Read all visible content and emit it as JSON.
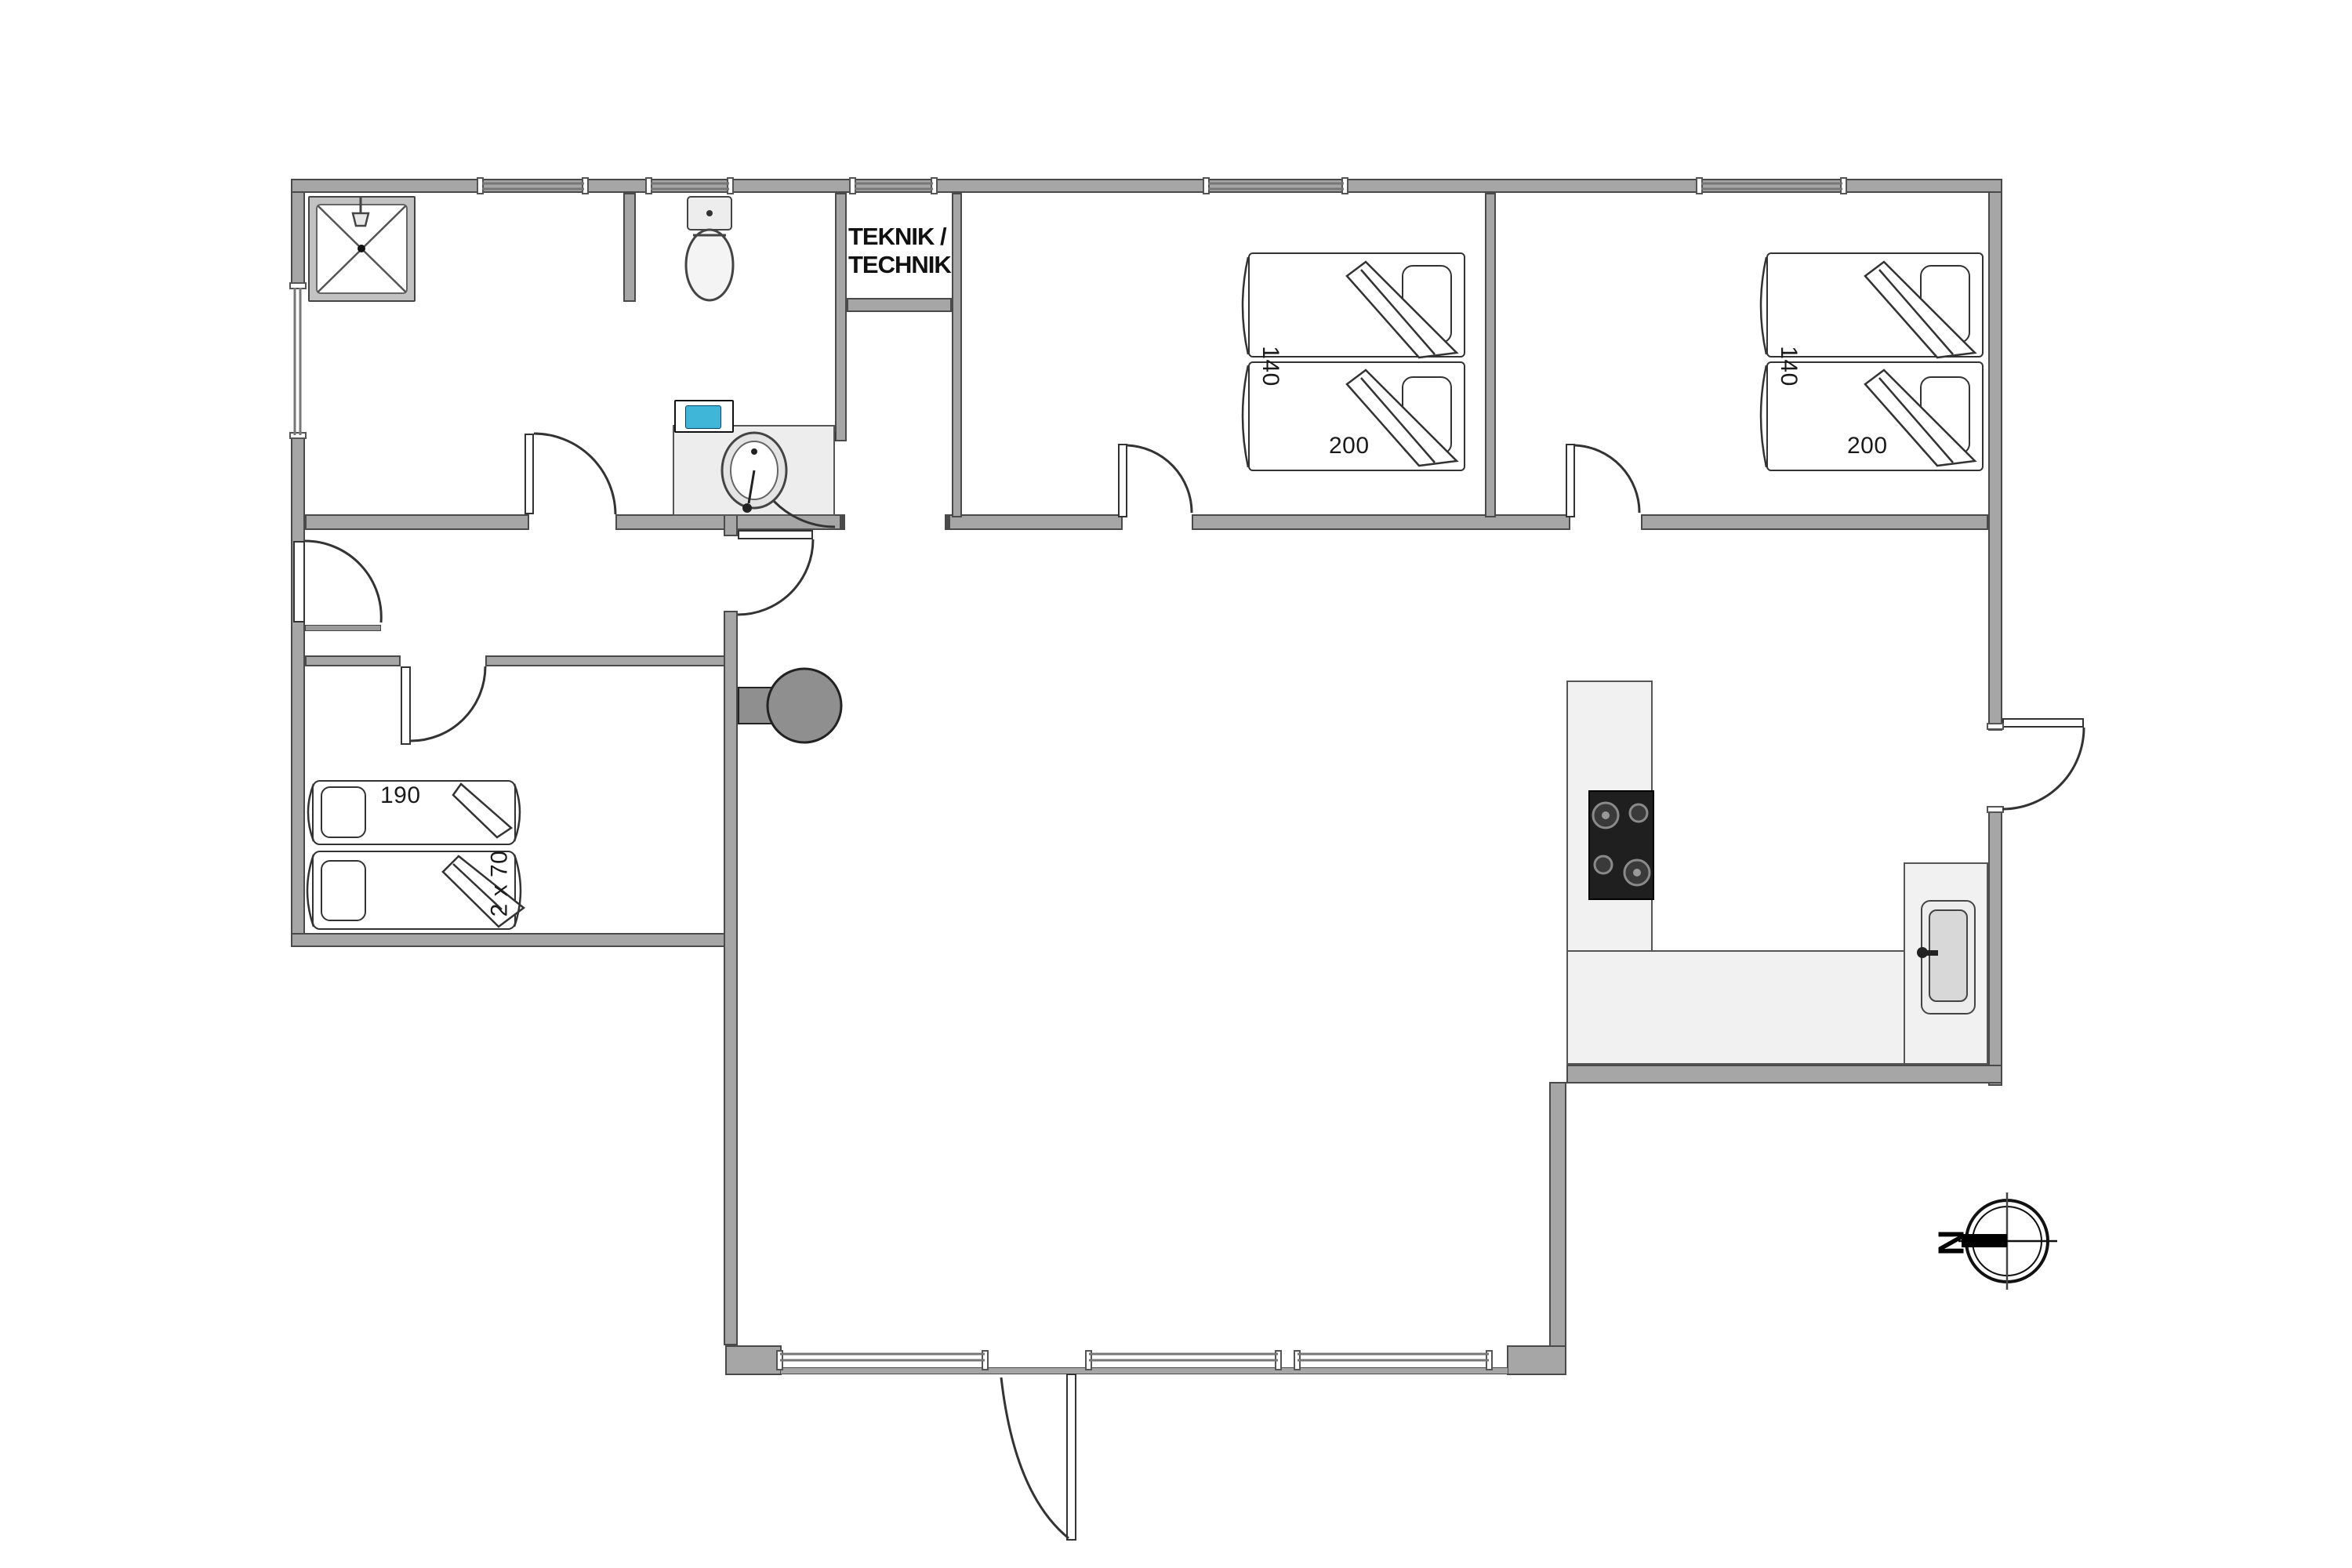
{
  "plan": {
    "technical_room": {
      "label_line1": "TEKNIK /",
      "label_line2": "TECHNIK"
    },
    "bedroom1": {
      "bed_width_label": "140",
      "bed_length_label": "200"
    },
    "bedroom2": {
      "bed_width_label": "140",
      "bed_length_label": "200"
    },
    "bedroom3": {
      "bed_length_label": "190",
      "bed_widths_label": "2 x 70"
    },
    "compass": {
      "north_label": "N"
    },
    "colors": {
      "wall_fill": "#a6a6a6",
      "wall_edge": "#4a4a4a",
      "counter_fill": "#f1f1f1",
      "cooktop_fill": "#1f1f1f",
      "stove_fill": "#8f8f8f",
      "appliance_screen": "#3fb6d8",
      "line": "#333333",
      "text": "#111111"
    }
  }
}
